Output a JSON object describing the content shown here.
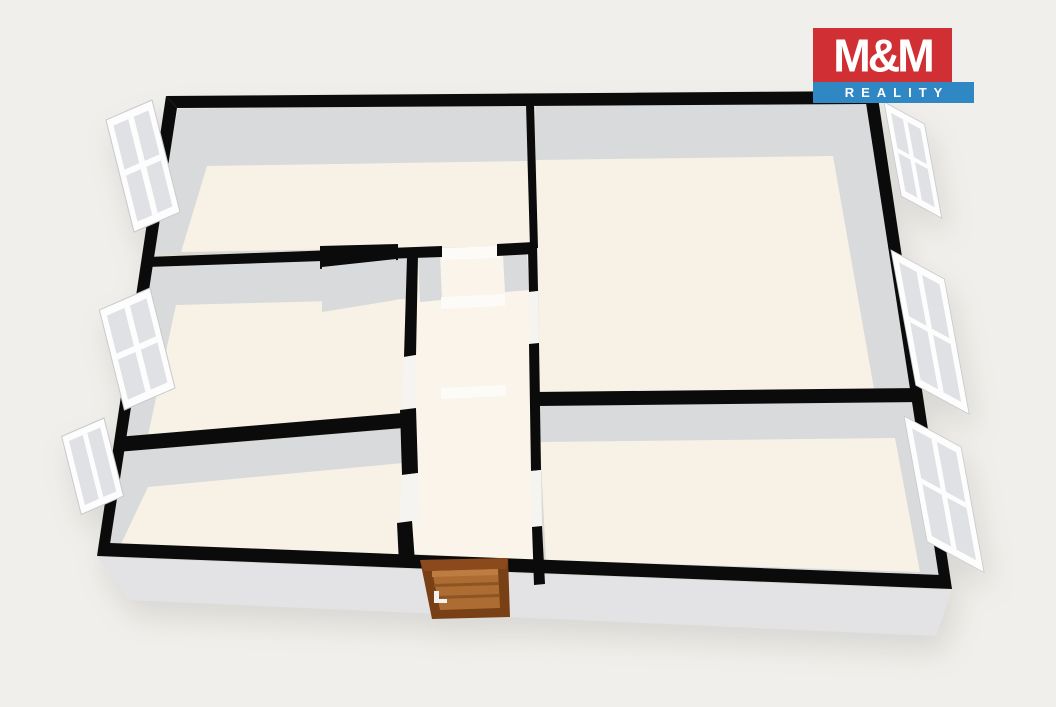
{
  "logo": {
    "brand": "M&M",
    "tagline": "REALITY",
    "brand_color": "#d02f34",
    "tagline_color": "#2f87c4",
    "text_color": "#ffffff"
  },
  "floorplan": {
    "type": "3d-floor-plan-render",
    "background_color": "#f0efeb",
    "wall_color": "#0b0b0b",
    "wall_inner_face_color": "#d8dadc",
    "wall_outer_face_color": "#e3e3e5",
    "floor_color": "#f8f1e6",
    "hallway_floor_color": "#faf4ea",
    "window_frame_color": "#fdfdfd",
    "window_glass_color": "#dfe1e4",
    "door_frame_color": "#7a4015",
    "door_panel_color": "#ad6c31",
    "rooms": [
      {
        "name": "room-top-left"
      },
      {
        "name": "room-top-right"
      },
      {
        "name": "room-middle-left"
      },
      {
        "name": "room-bottom-left"
      },
      {
        "name": "room-bottom-right"
      },
      {
        "name": "hallway"
      }
    ],
    "window_count": 6,
    "entrance_door_count": 1,
    "interior_door_openings": 5
  }
}
